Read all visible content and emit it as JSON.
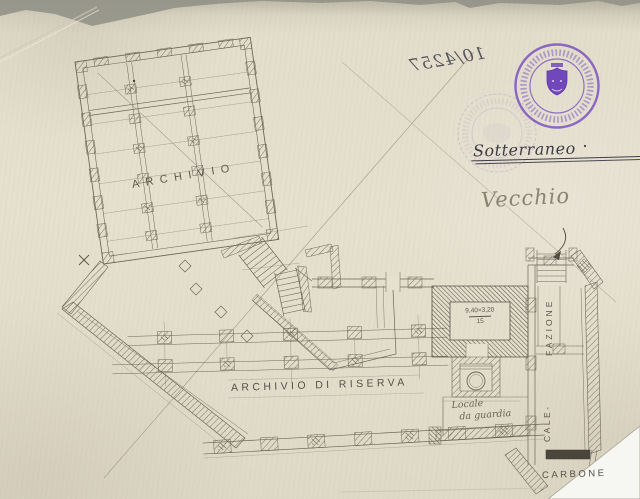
{
  "annotations": {
    "protocol_number_mirrored": "10/4257",
    "level_label": "Sotterraneo",
    "age_label": "Vecchio"
  },
  "plan_labels": {
    "archivio": "ARCHIVIO",
    "archivio_di_riserva": "ARCHIVIO DI RISERVA",
    "dimension_top": "9,40×3,20",
    "dimension_bottom": "15",
    "locale_line1": "Locale",
    "locale_line2": "da guardia",
    "calefazione_top": "FAZIONE",
    "calefazione_bottom": "CALE-",
    "carbone": "CARBONE"
  },
  "stamp": {
    "emblem": "shield",
    "shape": "circular"
  },
  "colors": {
    "paper": "#e6e0cf",
    "pencil": "#6e675a",
    "ink": "#3f3f4a",
    "stamp_purple": "#7b52c0",
    "stamp_shield": "#6b40ba"
  }
}
